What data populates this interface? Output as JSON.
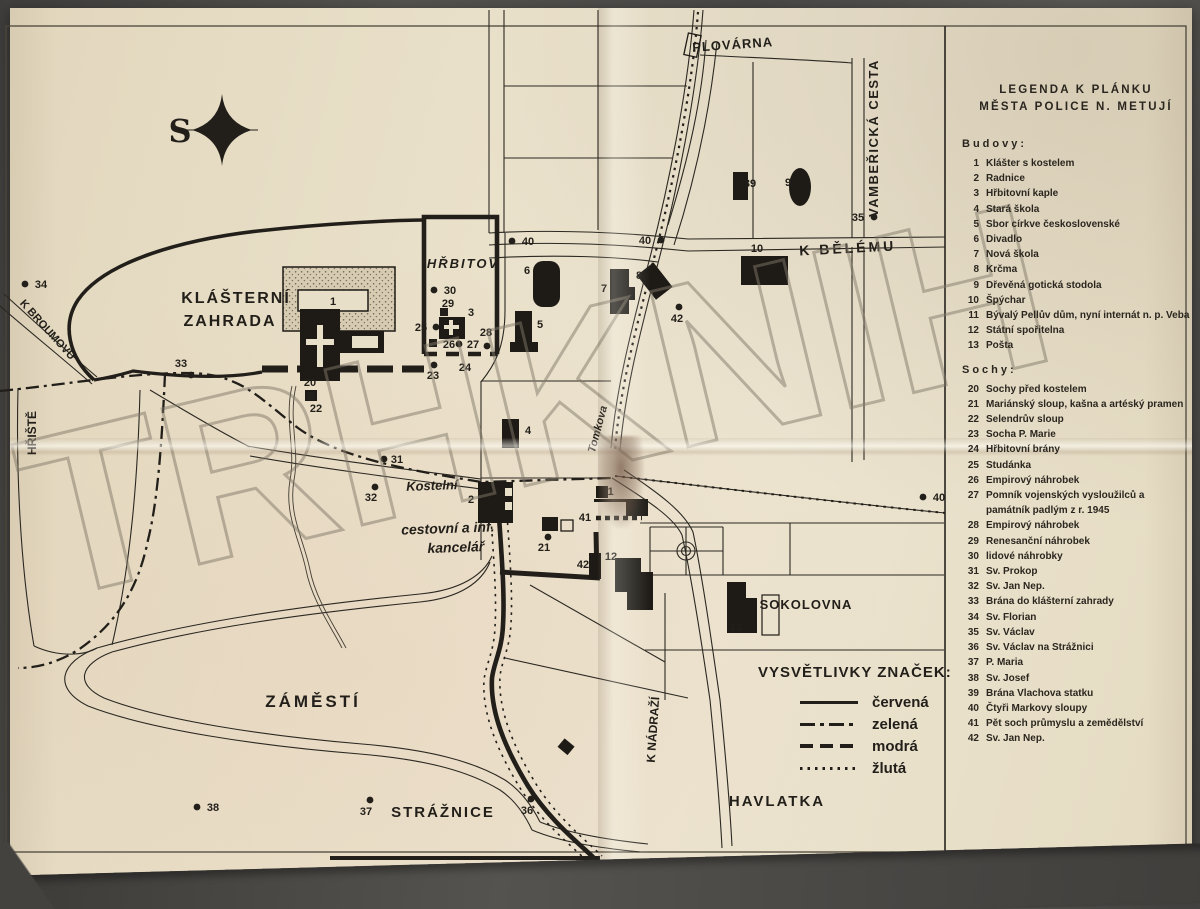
{
  "watermark": {
    "text": "TRHKNIH"
  },
  "compass": {
    "label": "S"
  },
  "legend_panel": {
    "title_lines": [
      "LEGENDA K PLÁNKU",
      "MĚSTA POLICE N. METUJÍ"
    ],
    "sections": [
      {
        "heading": "Budovy:",
        "items": [
          {
            "n": "1",
            "t": "Klášter s kostelem"
          },
          {
            "n": "2",
            "t": "Radnice"
          },
          {
            "n": "3",
            "t": "Hřbitovní kaple"
          },
          {
            "n": "4",
            "t": "Stará škola"
          },
          {
            "n": "5",
            "t": "Sbor církve československé"
          },
          {
            "n": "6",
            "t": "Divadlo"
          },
          {
            "n": "7",
            "t": "Nová škola"
          },
          {
            "n": "8",
            "t": "Krčma"
          },
          {
            "n": "9",
            "t": "Dřevěná gotická stodola"
          },
          {
            "n": "10",
            "t": "Špýchar"
          },
          {
            "n": "11",
            "t": "Bývalý Pellův dům, nyní internát n. p. Veba"
          },
          {
            "n": "12",
            "t": "Státní spořitelna"
          },
          {
            "n": "13",
            "t": "Pošta"
          }
        ]
      },
      {
        "heading": "Sochy:",
        "items": [
          {
            "n": "20",
            "t": "Sochy před kostelem"
          },
          {
            "n": "21",
            "t": "Mariánský sloup, kašna a artéský pramen"
          },
          {
            "n": "22",
            "t": "Selendrův sloup"
          },
          {
            "n": "23",
            "t": "Socha P. Marie"
          },
          {
            "n": "24",
            "t": "Hřbitovní brány"
          },
          {
            "n": "25",
            "t": "Studánka"
          },
          {
            "n": "26",
            "t": "Empirový náhrobek"
          },
          {
            "n": "27",
            "t": "Pomník vojenských vysloužilců a památník padlým z r. 1945"
          },
          {
            "n": "28",
            "t": "Empirový náhrobek"
          },
          {
            "n": "29",
            "t": "Renesanční náhrobek"
          },
          {
            "n": "30",
            "t": "lidové náhrobky"
          },
          {
            "n": "31",
            "t": "Sv. Prokop"
          },
          {
            "n": "32",
            "t": "Sv. Jan Nep."
          },
          {
            "n": "33",
            "t": "Brána do klášterní zahrady"
          },
          {
            "n": "34",
            "t": "Sv. Florian"
          },
          {
            "n": "35",
            "t": "Sv. Václav"
          },
          {
            "n": "36",
            "t": "Sv. Václav na Strážnici"
          },
          {
            "n": "37",
            "t": "P. Maria"
          },
          {
            "n": "38",
            "t": "Sv. Josef"
          },
          {
            "n": "39",
            "t": "Brána Vlachova statku"
          },
          {
            "n": "40",
            "t": "Čtyři Markovy sloupy"
          },
          {
            "n": "41",
            "t": "Pět soch průmyslu a zemědělství"
          },
          {
            "n": "42",
            "t": "Sv. Jan Nep."
          }
        ]
      }
    ]
  },
  "symbols_legend": {
    "title": "VYSVĚTLIVKY ZNAČEK:",
    "entries": [
      {
        "style": "solid",
        "label": "červená"
      },
      {
        "style": "dashdot",
        "label": "zelená"
      },
      {
        "style": "dashed",
        "label": "modrá"
      },
      {
        "style": "dotted",
        "label": "žlutá"
      }
    ]
  },
  "map": {
    "labels": [
      {
        "t": "PLOVÁRNA",
        "x": 733,
        "y": 49,
        "s": 13,
        "r": -4,
        "sp": 1
      },
      {
        "t": "VAMBEŘICKÁ CESTA",
        "x": 878,
        "y": 138,
        "s": 13,
        "r": -90,
        "sp": 1.5
      },
      {
        "t": "K BĚLÉMU",
        "x": 848,
        "y": 253,
        "s": 14,
        "r": -3,
        "sp": 3
      },
      {
        "t": "HŘBITOV",
        "x": 463,
        "y": 268,
        "s": 13,
        "sp": 2,
        "i": 1
      },
      {
        "t": "KLÁŠTERNÍ",
        "x": 236,
        "y": 303,
        "s": 16,
        "sp": 2
      },
      {
        "t": "ZAHRADA",
        "x": 230,
        "y": 326,
        "s": 16,
        "sp": 2
      },
      {
        "t": "K BROUMOVU",
        "x": 45,
        "y": 332,
        "s": 11,
        "r": 48
      },
      {
        "t": "HŘIŠTĚ",
        "x": 36,
        "y": 433,
        "s": 12,
        "r": -90
      },
      {
        "t": "Kostelní",
        "x": 432,
        "y": 490,
        "s": 13,
        "i": 1,
        "r": -2
      },
      {
        "t": "Tomkova",
        "x": 601,
        "y": 430,
        "s": 11,
        "i": 1,
        "r": -75
      },
      {
        "t": "cestovní a inf.",
        "x": 448,
        "y": 533,
        "s": 14,
        "i": 1,
        "r": -2
      },
      {
        "t": "kancelář",
        "x": 456,
        "y": 552,
        "s": 14,
        "i": 1,
        "r": -2
      },
      {
        "t": "SOKOLOVNA",
        "x": 806,
        "y": 609,
        "s": 13,
        "sp": 1
      },
      {
        "t": "ZÁMĚSTÍ",
        "x": 313,
        "y": 707,
        "s": 17,
        "sp": 3
      },
      {
        "t": "STRÁŽNICE",
        "x": 443,
        "y": 817,
        "s": 15,
        "sp": 2
      },
      {
        "t": "HAVLATKA",
        "x": 777,
        "y": 806,
        "s": 15,
        "sp": 2
      },
      {
        "t": "K NÁDRAŽÍ",
        "x": 657,
        "y": 730,
        "s": 12,
        "r": -86
      }
    ],
    "markers": [
      {
        "n": "34",
        "sh": "c",
        "x": 25,
        "y": 284,
        "lx": 41,
        "ly": 288
      },
      {
        "n": "33",
        "sh": "c",
        "x": 191,
        "y": 375,
        "lx": 181,
        "ly": 367
      },
      {
        "n": "30",
        "sh": "c",
        "x": 434,
        "y": 290,
        "lx": 450,
        "ly": 294
      },
      {
        "n": "40",
        "sh": "c",
        "x": 512,
        "y": 241,
        "lx": 528,
        "ly": 245
      },
      {
        "n": "40",
        "sh": "c",
        "x": 661,
        "y": 240,
        "lx": 645,
        "ly": 244
      },
      {
        "n": "35",
        "sh": "c",
        "x": 874,
        "y": 217,
        "lx": 858,
        "ly": 221
      },
      {
        "n": "40",
        "sh": "c",
        "x": 923,
        "y": 497,
        "lx": 939,
        "ly": 501
      },
      {
        "n": "42",
        "sh": "c",
        "x": 679,
        "y": 307,
        "lx": 677,
        "ly": 322
      },
      {
        "n": "29",
        "sh": "s",
        "x": 444,
        "y": 312,
        "lx": 448,
        "ly": 307
      },
      {
        "n": "3",
        "sh": "",
        "lx": 471,
        "ly": 316
      },
      {
        "n": "25",
        "sh": "c",
        "x": 436,
        "y": 327,
        "lx": 421,
        "ly": 331
      },
      {
        "n": "26",
        "sh": "s",
        "x": 433,
        "y": 343,
        "lx": 449,
        "ly": 348
      },
      {
        "n": "27",
        "sh": "c",
        "x": 459,
        "y": 344,
        "lx": 473,
        "ly": 348
      },
      {
        "n": "28",
        "sh": "c",
        "x": 487,
        "y": 346,
        "lx": 486,
        "ly": 336
      },
      {
        "n": "23",
        "sh": "c",
        "x": 434,
        "y": 365,
        "lx": 433,
        "ly": 379
      },
      {
        "n": "24",
        "sh": "",
        "lx": 465,
        "ly": 371
      },
      {
        "n": "20",
        "sh": "",
        "lx": 310,
        "ly": 386
      },
      {
        "n": "22",
        "sh": "s",
        "x": 311,
        "y": 396,
        "lx": 316,
        "ly": 412
      },
      {
        "n": "31",
        "sh": "c",
        "x": 384,
        "y": 459,
        "lx": 397,
        "ly": 463
      },
      {
        "n": "32",
        "sh": "c",
        "x": 375,
        "y": 487,
        "lx": 371,
        "ly": 501
      },
      {
        "n": "2",
        "sh": "",
        "lx": 471,
        "ly": 503
      },
      {
        "n": "21",
        "sh": "c",
        "x": 548,
        "y": 537,
        "lx": 544,
        "ly": 551
      },
      {
        "n": "4",
        "sh": "",
        "lx": 528,
        "ly": 434
      },
      {
        "n": "11",
        "sh": "",
        "lx": 608,
        "ly": 495
      },
      {
        "n": "41",
        "sh": "",
        "lx": 585,
        "ly": 521
      },
      {
        "n": "42",
        "sh": "",
        "lx": 583,
        "ly": 568
      },
      {
        "n": "12",
        "sh": "",
        "lx": 611,
        "ly": 560
      },
      {
        "n": "13",
        "sh": "",
        "lx": 736,
        "ly": 631
      },
      {
        "n": "1",
        "sh": "",
        "lx": 333,
        "ly": 305
      },
      {
        "n": "5",
        "sh": "",
        "lx": 540,
        "ly": 328
      },
      {
        "n": "6",
        "sh": "",
        "lx": 527,
        "ly": 274
      },
      {
        "n": "7",
        "sh": "",
        "lx": 604,
        "ly": 292
      },
      {
        "n": "8",
        "sh": "",
        "lx": 639,
        "ly": 279
      },
      {
        "n": "9",
        "sh": "",
        "lx": 788,
        "ly": 186
      },
      {
        "n": "10",
        "sh": "",
        "lx": 757,
        "ly": 252
      },
      {
        "n": "39",
        "sh": "",
        "lx": 750,
        "ly": 187
      },
      {
        "n": "36",
        "sh": "c",
        "x": 531,
        "y": 799,
        "lx": 527,
        "ly": 814
      },
      {
        "n": "37",
        "sh": "c",
        "x": 370,
        "y": 800,
        "lx": 366,
        "ly": 815
      },
      {
        "n": "38",
        "sh": "c",
        "x": 197,
        "y": 807,
        "lx": 213,
        "ly": 811
      }
    ]
  },
  "colors": {
    "paper": "#e8dfc9",
    "ink": "#221f1a",
    "surface": "#4e4c49",
    "watermark": "#80786"
  }
}
